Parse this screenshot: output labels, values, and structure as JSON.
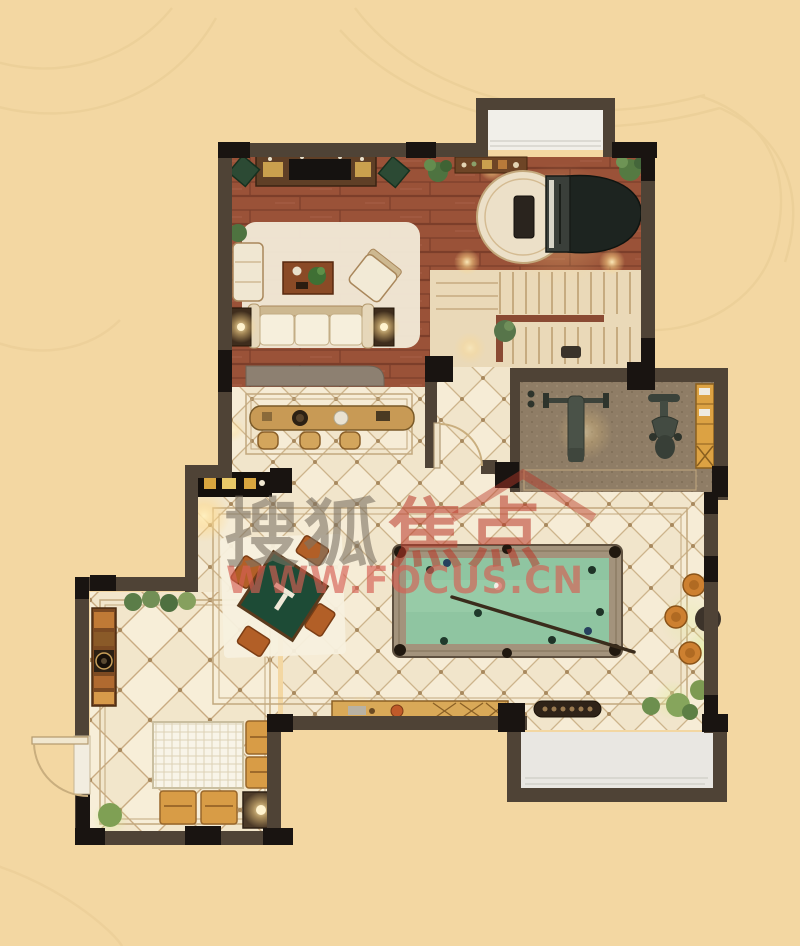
{
  "watermark": {
    "brand_gray": "搜狐",
    "brand_red": "焦点",
    "url": "WWW.FOCUS.CN"
  },
  "palette": {
    "background": "#f3d7a2",
    "wall": "#4f4336",
    "wall_pillar": "#191411",
    "wood_floor": "#9a5238",
    "tile_floor": "#f1e5cb",
    "tile_line": "#cdb48c",
    "stairs_floor": "#ead9b8",
    "gym_carpet": "#8f7d66",
    "pool_felt": "#8fc5a1",
    "pool_rail": "#a3937c",
    "mahjong_felt": "#1d4b36",
    "cabinet_wood": "#d9a958",
    "window_glass": "#efede7",
    "lamp_glow": "#ffd98a",
    "watermark_gray": "#7d7364",
    "watermark_red": "#ba3728",
    "watermark_pink": "#d65f54"
  },
  "rooms": [
    "living-room",
    "piano-area",
    "staircase",
    "gym",
    "hallway",
    "billiards-area",
    "mahjong-area",
    "dining-room",
    "entry"
  ],
  "furniture_icons": [
    "tv-console",
    "speakers",
    "sofa",
    "armchair",
    "coffee-table",
    "floor-lamp",
    "grand-piano",
    "piano-bench",
    "round-rug",
    "console-table",
    "handrail",
    "bench-press",
    "exercise-bike",
    "gym-cabinet",
    "bar-counter",
    "bar-stool",
    "wall-cabinet",
    "mahjong-table",
    "mahjong-chair",
    "billiards-table",
    "cue-stick",
    "billiard-balls",
    "round-stool",
    "sideboard",
    "dining-table",
    "dining-chair",
    "table-lamp",
    "shoe-cabinet",
    "shoe-bench",
    "potted-plant",
    "bay-window",
    "door-swing"
  ]
}
